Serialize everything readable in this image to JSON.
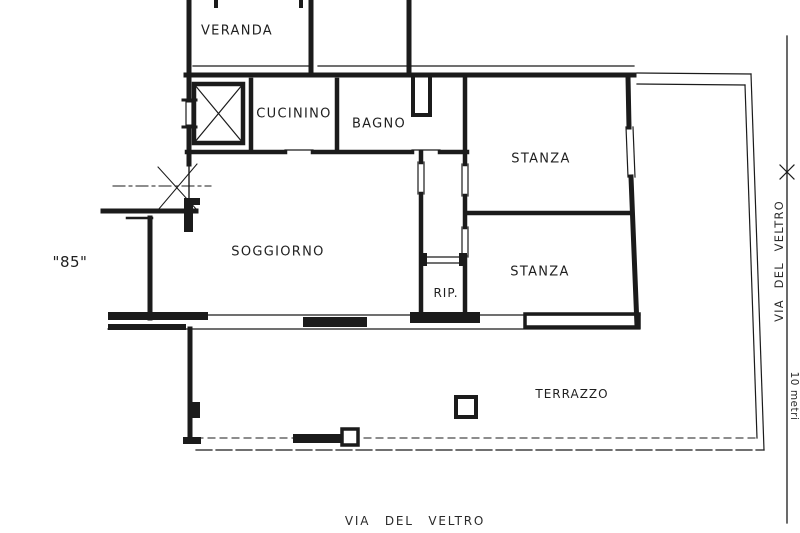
{
  "plan": {
    "unit_number": "\"85\"",
    "rooms": {
      "veranda": "VERANDA",
      "cucinino": "CUCININO",
      "bagno": "BAGNO",
      "stanza_top": "STANZA",
      "soggiorno": "SOGGIORNO",
      "rip": "RIP.",
      "stanza_bottom": "STANZA",
      "terrazzo": "TERRAZZO"
    },
    "street_label_bottom": "VIA DEL VELTRO",
    "street_label_right": "VIA DEL VELTRO",
    "scale_label": "10 metri",
    "colors": {
      "ink": "#1b1b1b",
      "paper": "#ffffff"
    }
  }
}
